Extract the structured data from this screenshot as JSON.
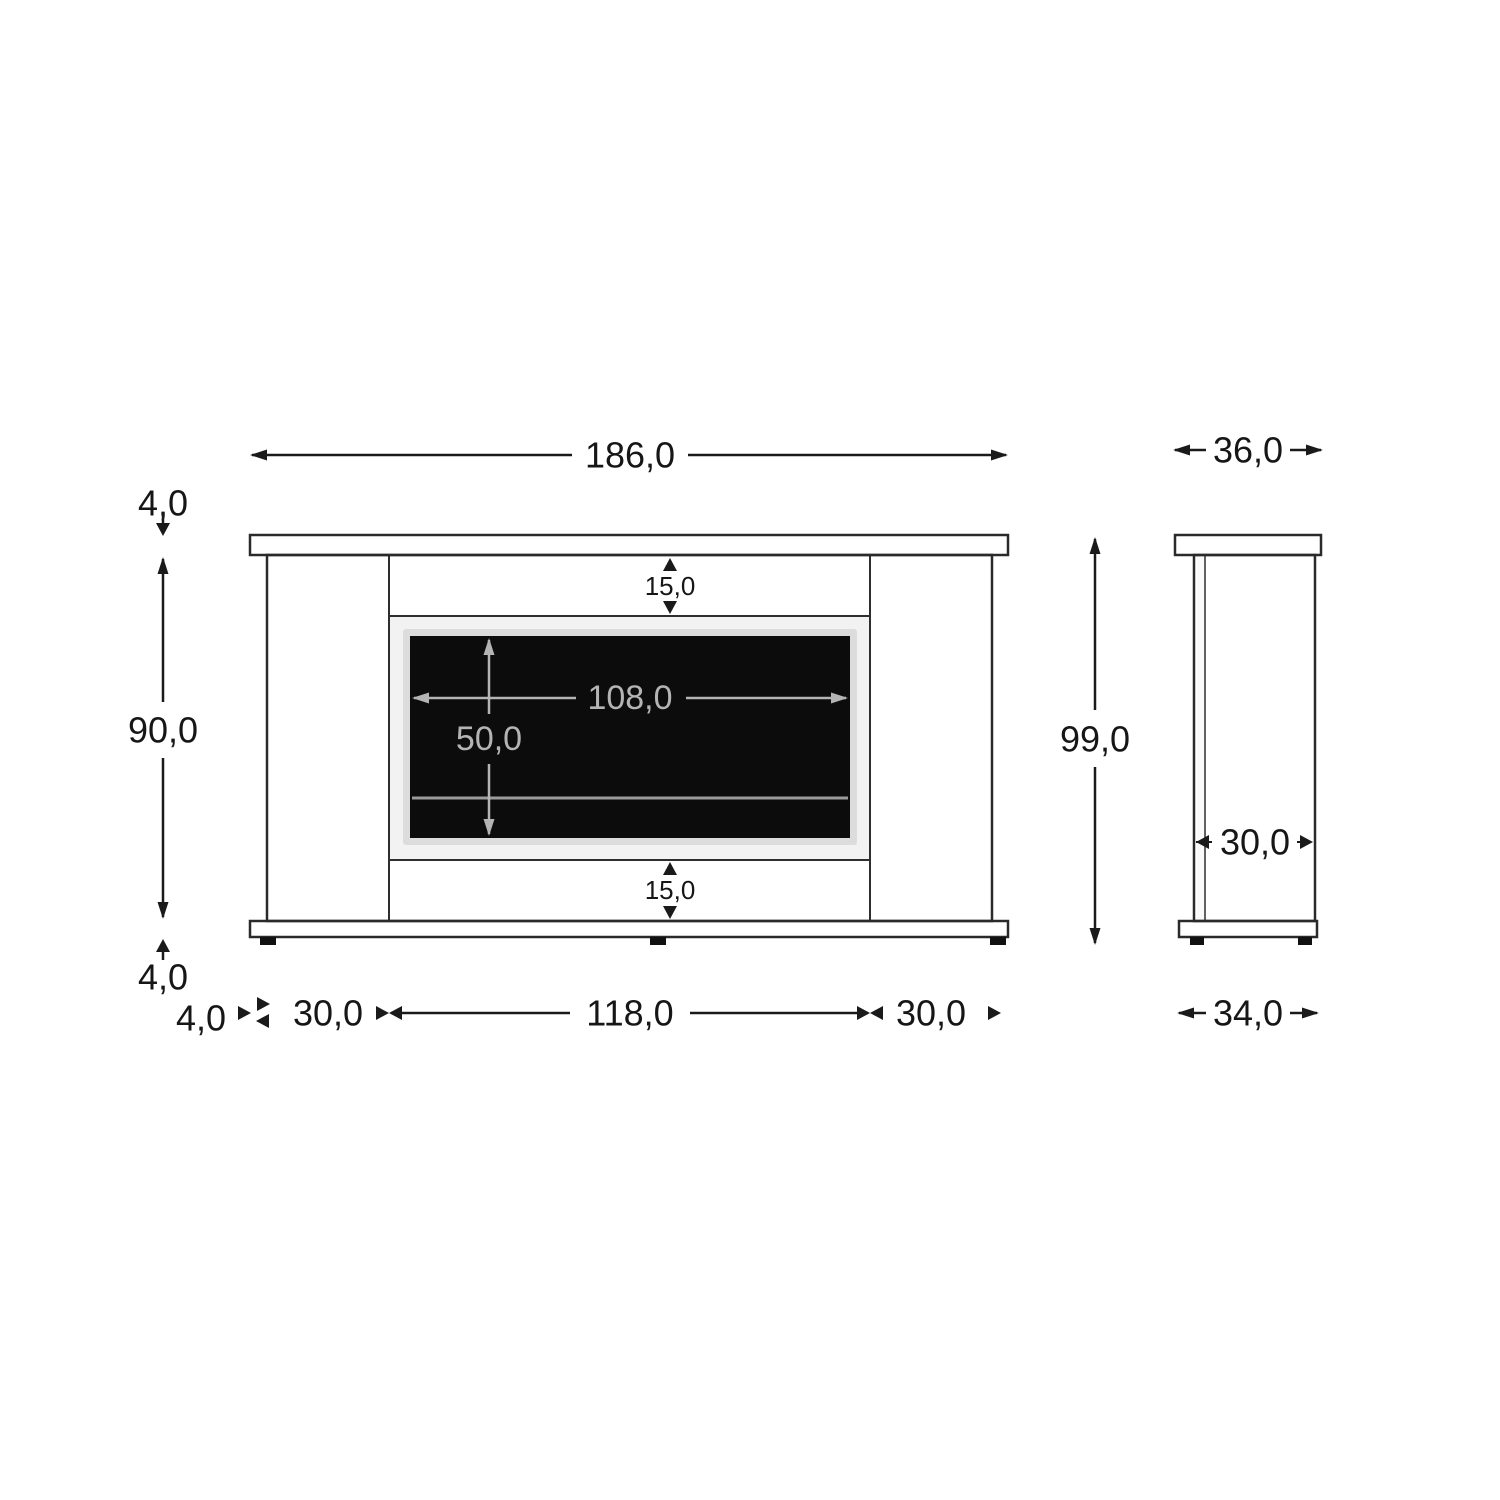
{
  "diagram": {
    "front_view": {
      "overall_width": "186,0",
      "top_board_thickness": "4,0",
      "body_height": "90,0",
      "bottom_board_thickness": "4,0",
      "top_inset": "15,0",
      "bottom_inset": "15,0",
      "window_width": "108,0",
      "window_height": "50,0",
      "base_overhang": "4,0",
      "left_pillar_width": "30,0",
      "opening_width": "118,0",
      "right_pillar_width": "30,0"
    },
    "side_view": {
      "top_board_depth": "36,0",
      "overall_height": "99,0",
      "body_depth": "30,0",
      "base_board_depth": "34,0"
    },
    "colors": {
      "wood": "#ECA766",
      "body": "#ECECEC",
      "panel": "#F2F2F2",
      "window": "#0C0C0C",
      "window_halo": "#DCDCDC",
      "ember_line": "#9B9B9B",
      "dim_black": "#1A1A1A",
      "dim_gray": "#B4B4B4"
    }
  }
}
